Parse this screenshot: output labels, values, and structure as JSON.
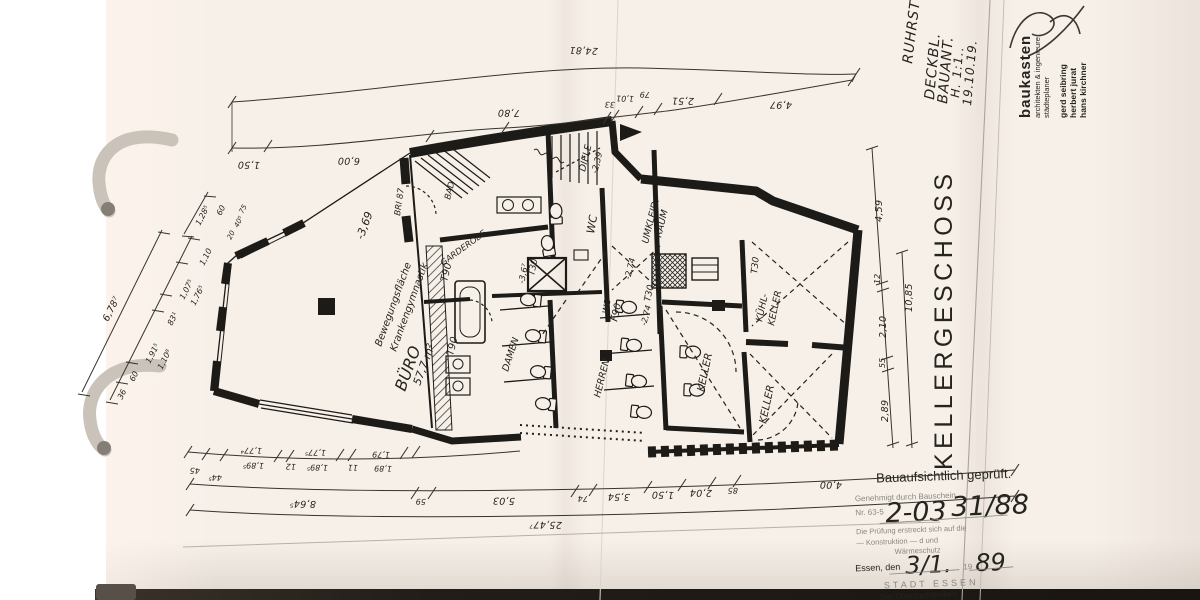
{
  "document": {
    "drawing_title": "KELLERGESCHOSS",
    "paper_color": "#f7f0e9",
    "ink_color": "#1d1b18"
  },
  "header_notes": {
    "l1": "RUHRST",
    "l2": "DECKBL.",
    "l3": "BAUANT.",
    "l4": "H. 1:1..",
    "l5": "19.10.19."
  },
  "architects": {
    "firm": "baukasten",
    "sub1": "architekten & ingenieure",
    "sub2": "städteplaner",
    "p1": "gerd seibring",
    "p2": "herbert jurat",
    "p3": "hans kirchner"
  },
  "stamp": {
    "line1": "Bauaufsichtlich geprüft.",
    "line2": "Genehmigt durch Bauschein",
    "line3_printed": "Nr. 63-5",
    "line3_hand_a": "2-03",
    "line3_hand_b": "31/88",
    "line4": "Die Prüfung erstreckt sich auf die",
    "line5": "— Konstruktion —  d       und",
    "line6": "Wärmeschutz",
    "line7_printed": "Essen, den",
    "line7_hand_day": "3/1.",
    "line7_year_prefix": "19",
    "line7_hand_year": "89",
    "line8": "STADT ESSEN",
    "line9": "Der Oberstadtdirektor"
  },
  "dims": {
    "top": {
      "overall": "24,81",
      "s1": "1,50",
      "s2": "6,00",
      "s3": "7,80",
      "s4": "33",
      "s5": "1,01",
      "s6": "79",
      "s7": "2,51",
      "s8": "4,97"
    },
    "bottom": {
      "overall": "25,47⁷",
      "s1": "8,64⁵",
      "s2": "59",
      "s3": "5,03",
      "s4": "74",
      "s5": "3,54",
      "s6": "1,50",
      "s7": "2,04",
      "s8": "85",
      "s9": "4,00",
      "sub1": "45",
      "sub2": "44⁵",
      "sub3": "1,77⁴",
      "sub4": "1,89⁵",
      "sub5": "12",
      "sub6": "1,77⁵",
      "sub7": "1,89⁵",
      "sub8": "11",
      "sub9": "1,79",
      "sub10": "1,89"
    },
    "left": {
      "overall": "6,78⁷",
      "s1": "36",
      "s2": "60",
      "s3": "1,91⁵",
      "s4": "1,10⁸",
      "s5": "83¹",
      "s6": "1,07⁵",
      "s7": "1,76⁵",
      "s8": "1,10",
      "u1": "1,28⁵",
      "u2": "60",
      "u3": "20",
      "u4": "40⁵",
      "u5": "75"
    },
    "right": {
      "overall": "10,85",
      "s1": "4,59",
      "s2": "12",
      "s3": "2,10",
      "s4": "55",
      "s5": "2,89"
    }
  },
  "rooms": {
    "buero": "BÜRO",
    "buero_area": "57,7 m²",
    "note_level": "-3,69",
    "note1": "Bewegungsfläche",
    "note2": "Krankengymnastik",
    "diele": "DIELE",
    "diele_level": "-2,39",
    "wc": "WC",
    "wc2": "WC",
    "garderobe": "GARDEROBE",
    "bad": "BAD",
    "damen": "DAMEN",
    "herren": "HERREN",
    "umkleid1": "UMKLEID.",
    "umkleid2": "RAUM",
    "keller": "KELLER",
    "keller2": "KELLER",
    "kuehl1": "KÜHL-",
    "kuehl2": "KELLER",
    "bri": "BRI 87",
    "lvl274": "-2,74",
    "lvl274b": "-2,74",
    "lvl367": "-3,6⁷"
  },
  "doors": {
    "t90a": "T90",
    "t90b": "T90",
    "t30a": "T30",
    "t30b": "T30",
    "t30c": "T30",
    "f90a": "F90"
  }
}
